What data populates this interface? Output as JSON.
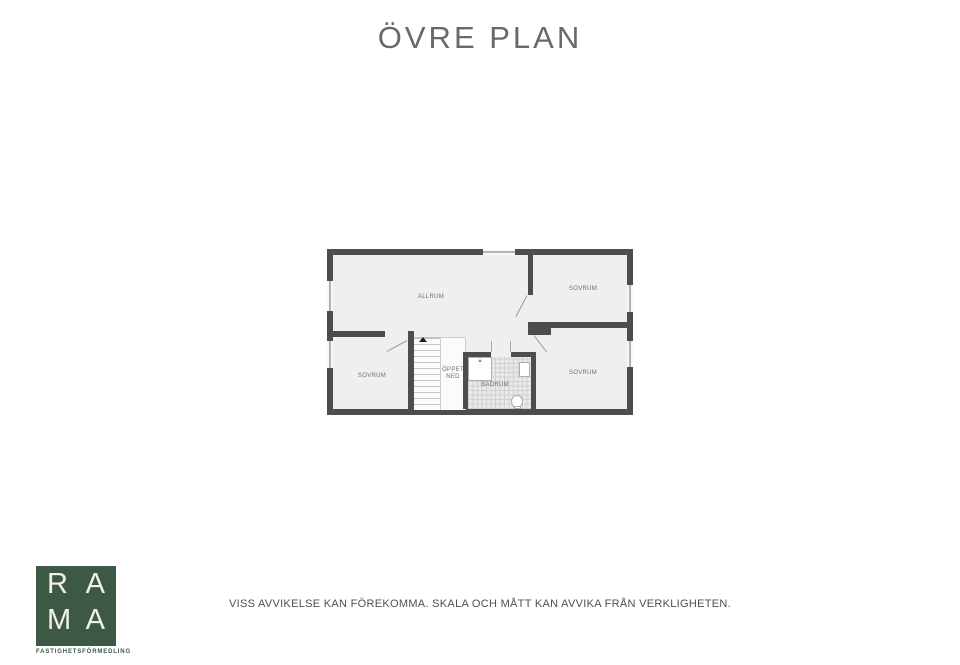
{
  "title": "ÖVRE PLAN",
  "plan": {
    "labels": {
      "allrum": "ALLRUM",
      "sovrum_top_right": "SOVRUM",
      "sovrum_bottom_left": "SOVRUM",
      "sovrum_bottom_right": "SOVRUM",
      "badrum": "BADRUM",
      "oppet_ned": "ÖPPET\nNED"
    },
    "fixtures": [
      "shower",
      "sink",
      "toilet",
      "stairs"
    ]
  },
  "logo": {
    "letters": [
      "R",
      "A",
      "M",
      "A"
    ],
    "tagline": "FASTIGHETSFÖRMEDLING",
    "brand_color": "#3d5945",
    "letter_color": "#f3f0e7"
  },
  "footer": {
    "disclaimer": "VISS AVVIKELSE KAN FÖREKOMMA. SKALA OCH MÅTT KAN AVVIKA FRÅN VERKLIGHETEN."
  },
  "colors": {
    "wall": "#4d4d4d",
    "floor": "#f0efed",
    "tile": "#ebe9e7",
    "title_text": "#696969",
    "label_text": "#6f6f6f"
  }
}
